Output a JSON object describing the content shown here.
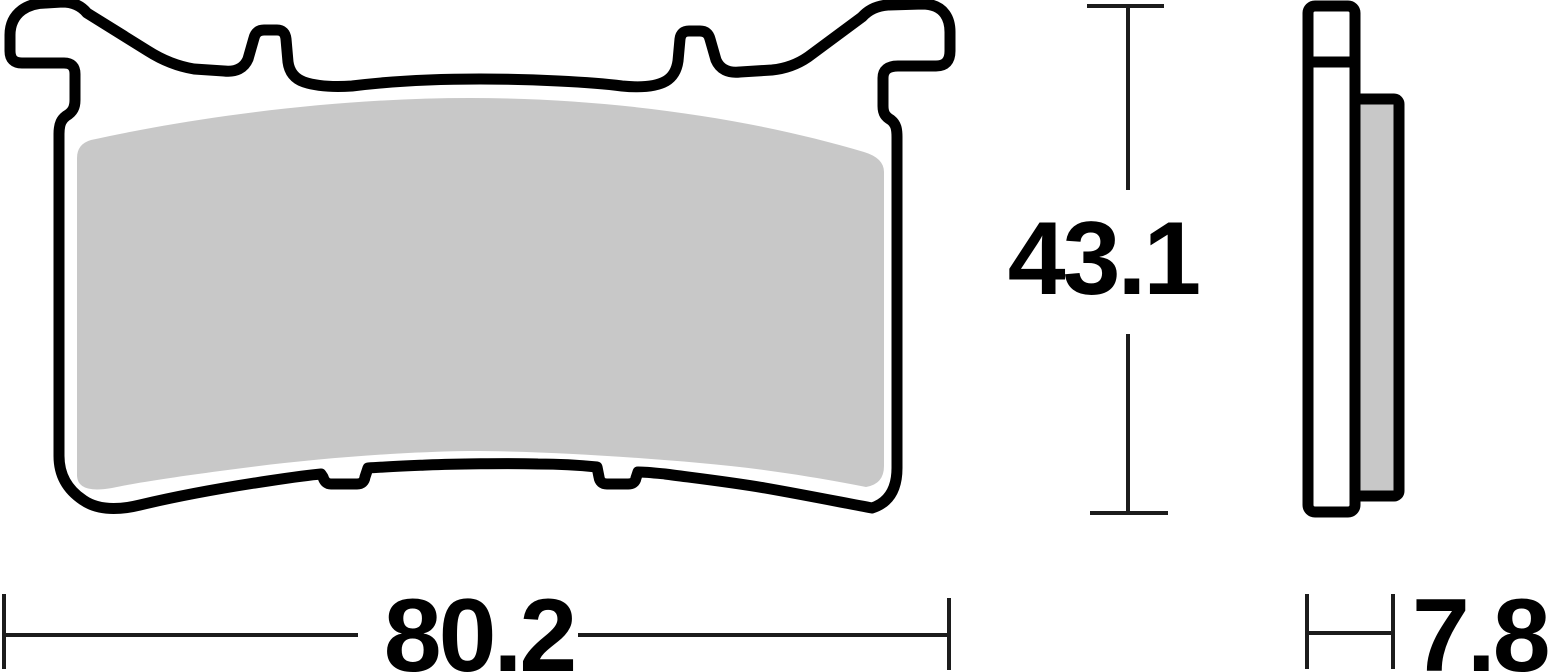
{
  "page": {
    "background": "#ffffff"
  },
  "diagram": {
    "type": "technical-drawing",
    "subject": "brake-pad-two-view-drawing",
    "views": {
      "front": {
        "name": "front-profile-with-mounting-ears"
      },
      "side": {
        "name": "side-profile-backplate-and-friction"
      }
    },
    "dimensions": {
      "width": {
        "value": "80.2"
      },
      "height": {
        "value": "43.1"
      },
      "thickness": {
        "value": "7.8"
      }
    },
    "colors": {
      "outline": "#000000",
      "friction_material": "#c8c8c8",
      "backplate_fill": "#ffffff",
      "dimension_lines": "#1c1c1c",
      "text": "#000000"
    }
  }
}
